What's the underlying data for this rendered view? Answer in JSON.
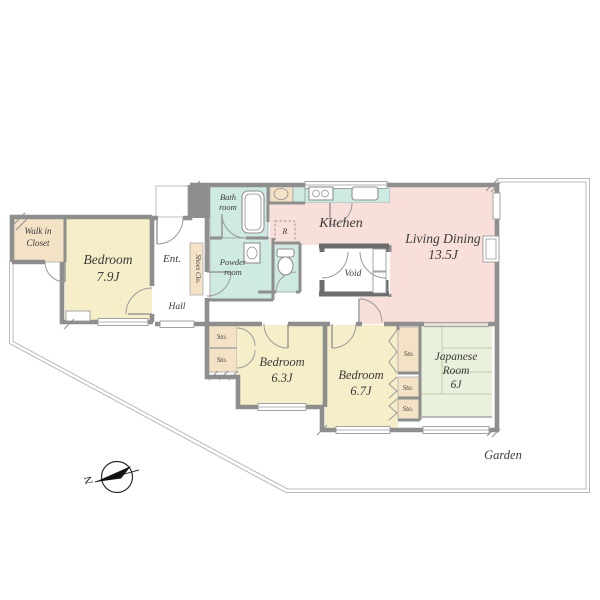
{
  "plan": {
    "rooms": {
      "walk_in_closet": {
        "name_line1": "Walk in",
        "name_line2": "Closet"
      },
      "bedroom_79": {
        "name": "Bedroom",
        "size": "7.9J"
      },
      "entrance": {
        "label": "Ent."
      },
      "shoes_closet": {
        "label": "Shoes Clo."
      },
      "hall": {
        "label": "Hall"
      },
      "bath_room": {
        "name_line1": "Bath",
        "name_line2": "room"
      },
      "powder_room": {
        "name_line1": "Powder",
        "name_line2": "room"
      },
      "refrigerator": {
        "label": "R"
      },
      "kitchen": {
        "label": "Kitchen"
      },
      "living_dining": {
        "name": "Living Dining",
        "size": "13.5J"
      },
      "void": {
        "label": "Void"
      },
      "bedroom_63": {
        "name": "Bedroom",
        "size": "6.3J"
      },
      "bedroom_67": {
        "name": "Bedroom",
        "size": "6.7J"
      },
      "japanese_room": {
        "name_line1": "Japanese",
        "name_line2": "Room",
        "size": "6J"
      },
      "storage": {
        "label": "Sto."
      },
      "garden": {
        "label": "Garden"
      }
    },
    "compass": {
      "north": "N"
    },
    "colors": {
      "bedroom_fill": "#f6eec9",
      "closet_fill": "#f4e2c6",
      "wet_fill": "#cfe9e3",
      "living_fill": "#f8dfd9",
      "tatami_fill": "#e9f0db",
      "wall": "#8e8e8e",
      "void_wall": "#6c6c6c",
      "boundary": "#b9b9b9"
    }
  }
}
